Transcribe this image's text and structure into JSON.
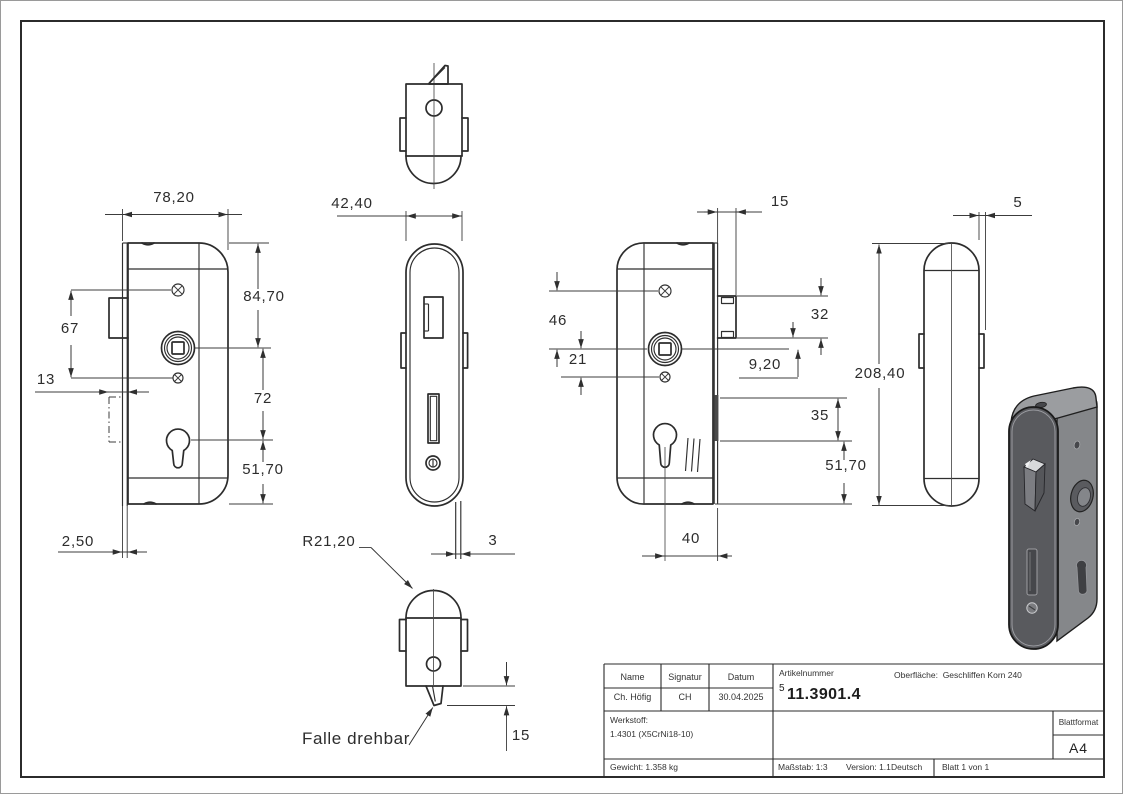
{
  "dims": {
    "d78": "78,20",
    "d84": "84,70",
    "d67": "67",
    "d13": "13",
    "d72": "72",
    "d51a": "51,70",
    "d25": "2,50",
    "d42": "42,40",
    "d3": "3",
    "r21": "R21,20",
    "falle": "Falle drehbar",
    "d15a": "15",
    "d15b": "15",
    "d46": "46",
    "d21": "21",
    "d32": "32",
    "d92": "9,20",
    "d35": "35",
    "d51b": "51,70",
    "d40": "40",
    "d208": "208,40",
    "d5": "5"
  },
  "title_block": {
    "col_name_label": "Name",
    "col_signature_label": "Signatur",
    "col_date_label": "Datum",
    "name_value": "Ch. Höfig",
    "signature_value": "CH",
    "date_value": "30.04.2025",
    "article_label": "Artikelnummer",
    "article_sup": "5",
    "article_number": "11.3901.4",
    "surface_label": "Oberfläche:",
    "surface_value": "Geschliffen Korn 240",
    "material_label": "Werkstoff:",
    "material_value": "1.4301 (X5CrNi18-10)",
    "weight_text": "Gewicht: 1.358 kg",
    "scale_text": "Maßstab: 1:3",
    "version_text": "Version: 1.1",
    "language_text": "Deutsch",
    "sheet_text": "Blatt 1 von 1",
    "format_label": "Blattformat",
    "format_value": "A4"
  },
  "colors": {
    "drawing_line": "#2c2c2c",
    "dimension_line": "#3c3c3c",
    "render_body": "#85878a",
    "render_faceplate": "#595a5e",
    "render_top_face": "#9b9da0",
    "render_highlight": "#d8d9db",
    "render_dark_detail": "#46474b"
  }
}
